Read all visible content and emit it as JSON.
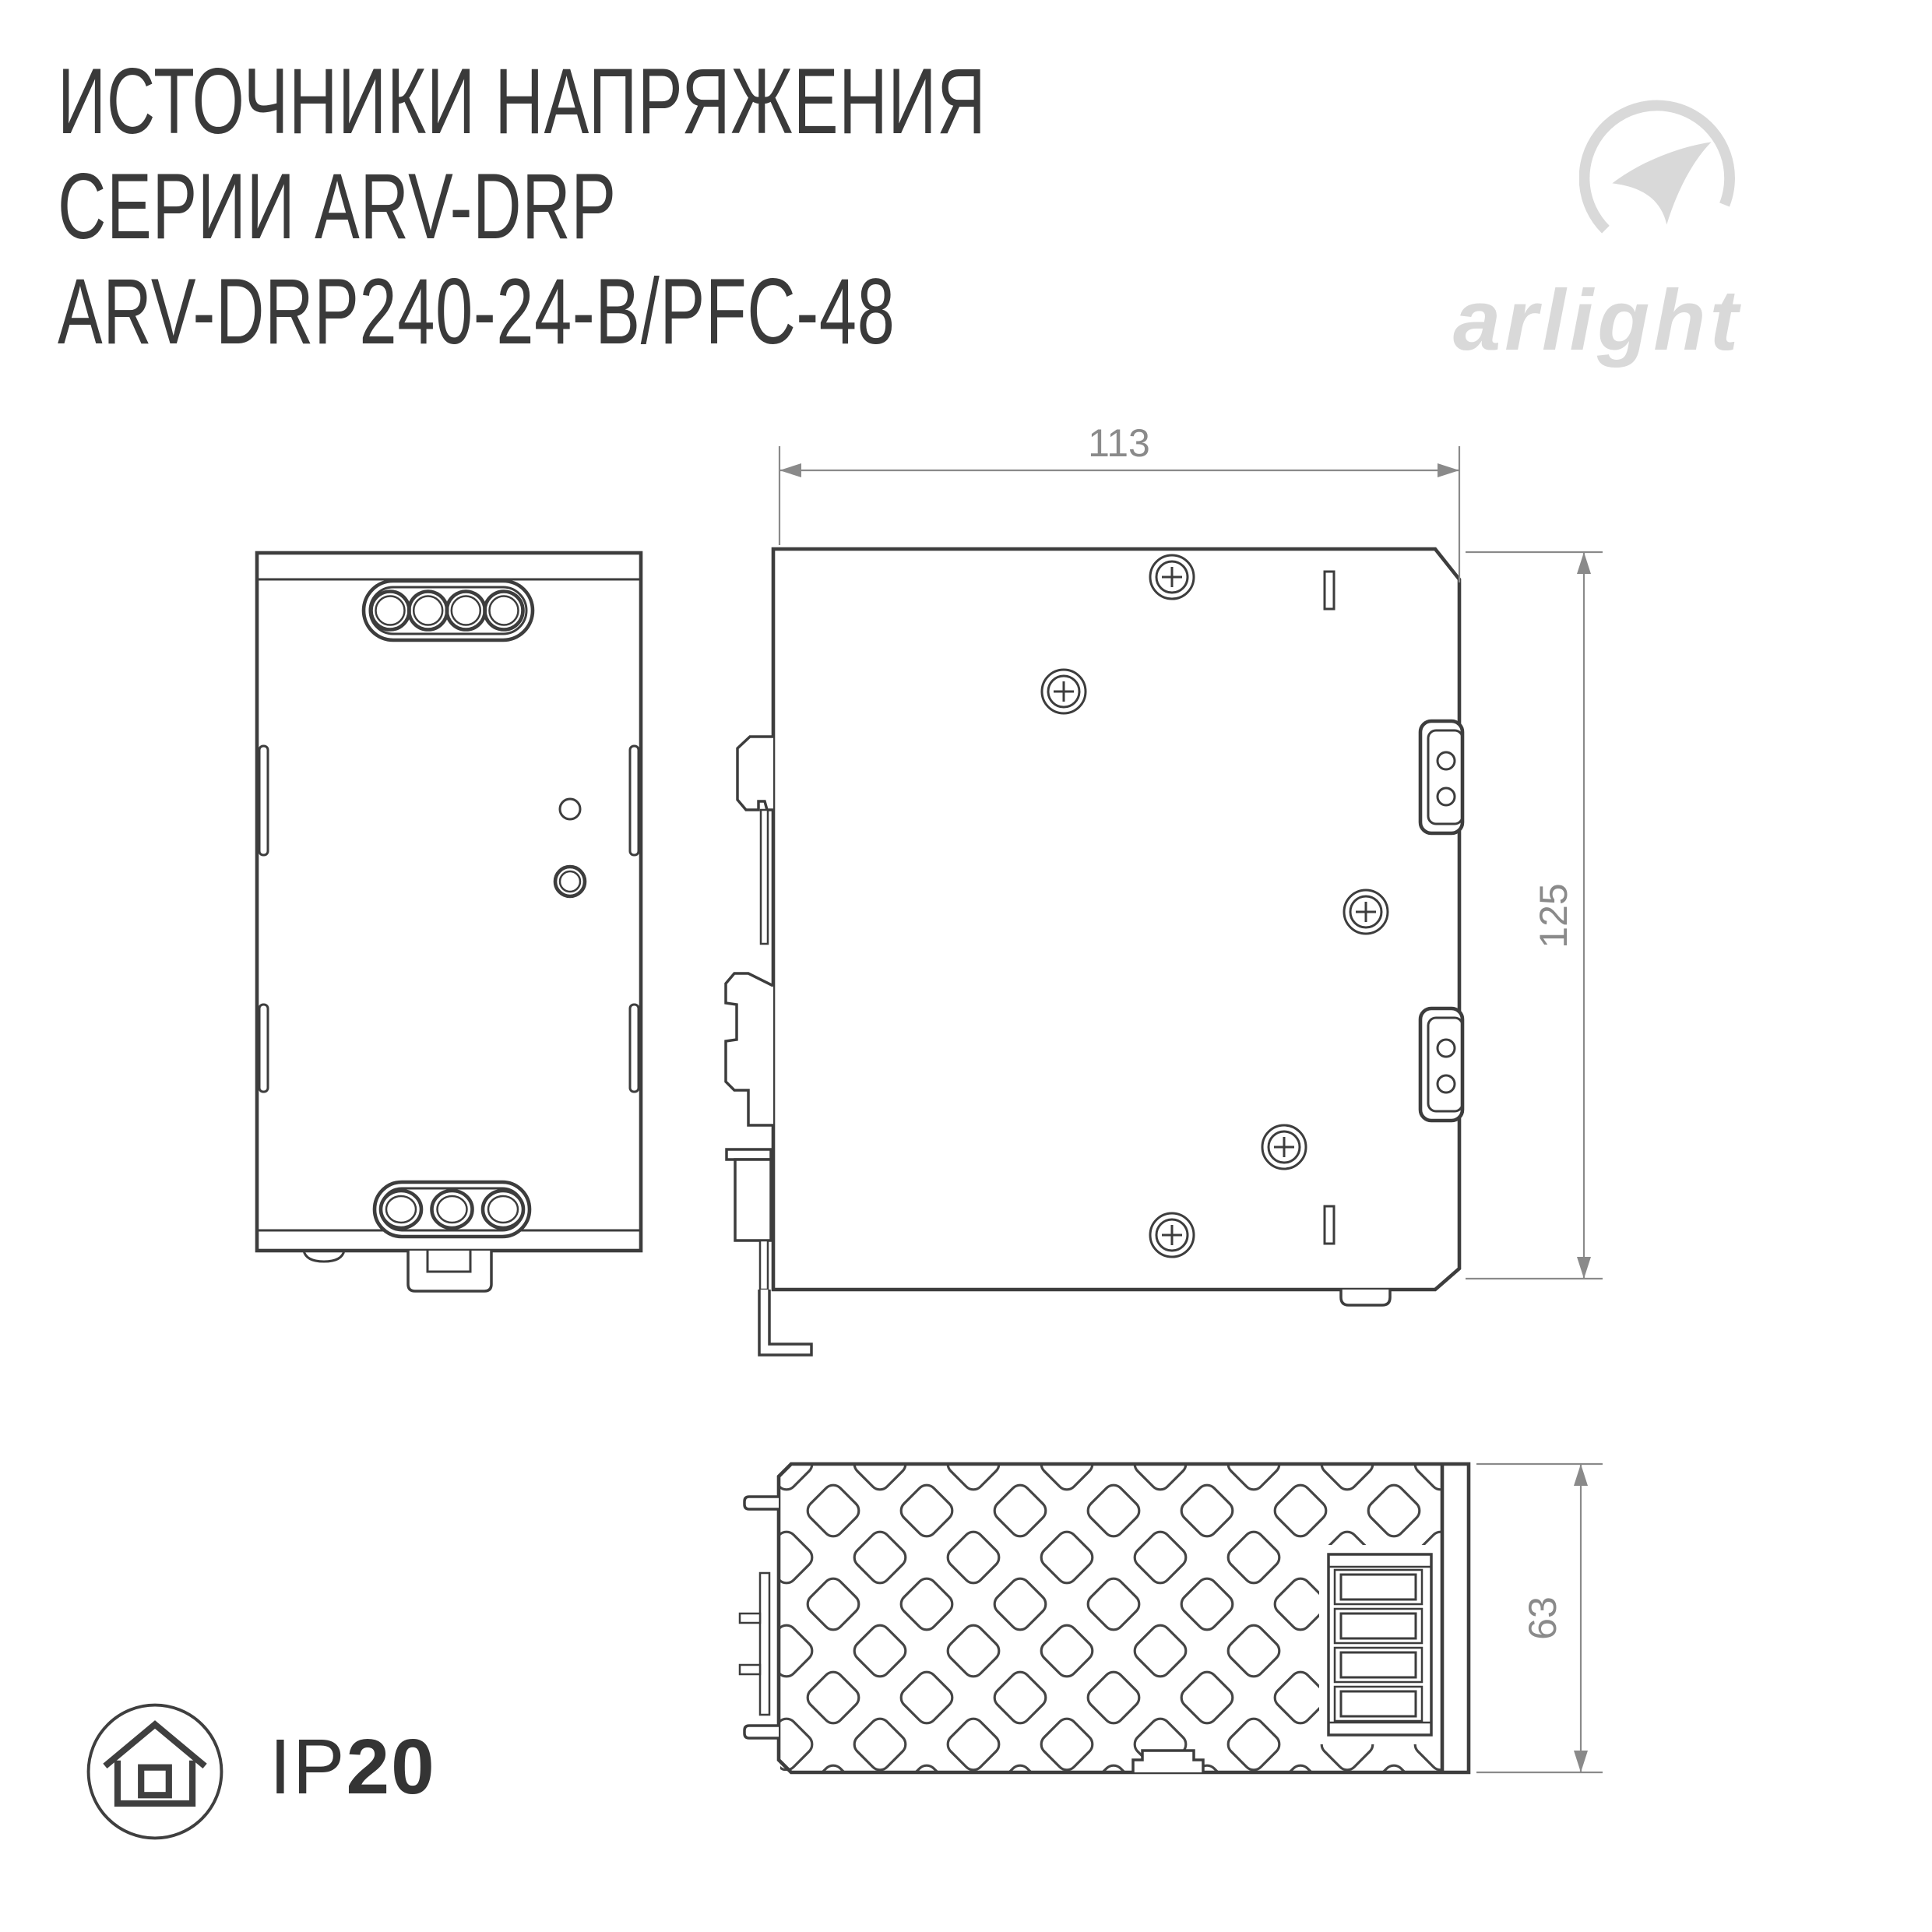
{
  "title": {
    "line1": "ИСТОЧНИКИ НАПРЯЖЕНИЯ",
    "line2": "СЕРИИ ARV-DRP",
    "line3": "ARV-DRP240-24-B/PFC-48"
  },
  "logo": {
    "text": "arlight"
  },
  "drawing": {
    "dim_width": "113",
    "dim_height": "125",
    "dim_depth": "63"
  },
  "ip_rating": {
    "prefix": "IP",
    "value": "20"
  },
  "colors": {
    "line": "#3d3d3d",
    "dimension": "#8a8a8a",
    "logo": "#d9d9d9",
    "title_text": "#3a3a3a"
  }
}
